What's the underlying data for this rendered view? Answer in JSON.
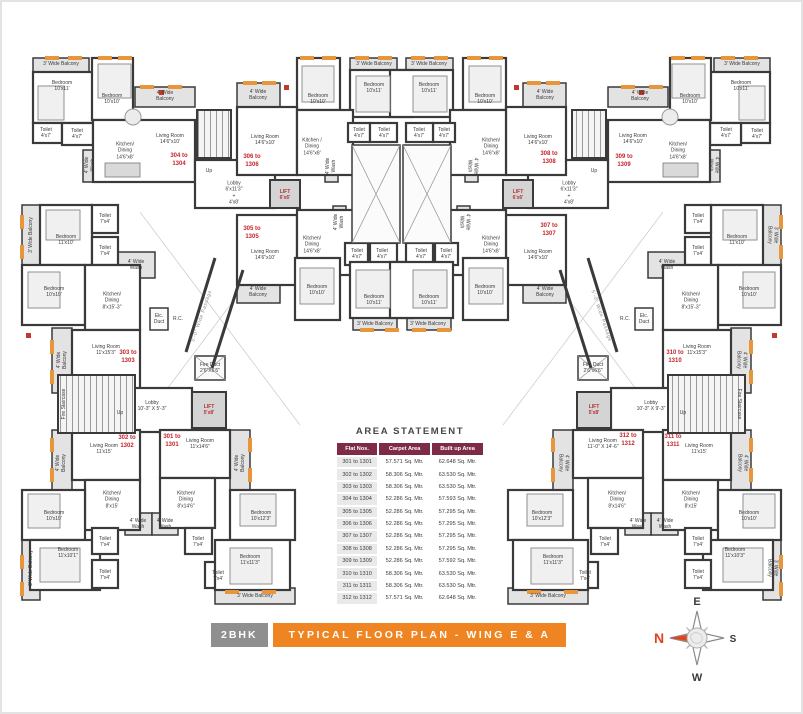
{
  "title_bar": {
    "badge": "2BHK",
    "title": "TYPICAL FLOOR PLAN - WING E & A"
  },
  "compass": {
    "north": "N",
    "east": "E",
    "south": "S",
    "west": "W"
  },
  "colors": {
    "accent_orange": "#ee8522",
    "wall": "#3a3a3a",
    "unit_red": "#c4242b",
    "table_maroon": "#7d2b47",
    "badge_gray": "#8f8f8f",
    "sill_orange": "#e8963c"
  },
  "area_statement": {
    "title": "AREA STATEMENT",
    "headers": [
      "Flat Nos.",
      "Carpet Area",
      "Built up Area"
    ],
    "rows": [
      [
        "301 to 1301",
        "57.571 Sq. Mtr.",
        "62.648 Sq. Mtr."
      ],
      [
        "302 to 1302",
        "58.306 Sq. Mtr.",
        "63.530 Sq. Mtr."
      ],
      [
        "303 to 1303",
        "58.306 Sq. Mtr.",
        "63.530 Sq. Mtr."
      ],
      [
        "304 to 1304",
        "52.286 Sq. Mtr.",
        "57.593 Sq. Mtr."
      ],
      [
        "305 to 1305",
        "52.286 Sq. Mtr.",
        "57.295 Sq. Mtr."
      ],
      [
        "306 to 1306",
        "52.286 Sq. Mtr.",
        "57.295 Sq. Mtr."
      ],
      [
        "307 to 1307",
        "52.286 Sq. Mtr.",
        "57.295 Sq. Mtr."
      ],
      [
        "308 to 1308",
        "52.286 Sq. Mtr.",
        "57.295 Sq. Mtr."
      ],
      [
        "309 to 1309",
        "52.286 Sq. Mtr.",
        "57.592 Sq. Mtr."
      ],
      [
        "310 to 1310",
        "58.306 Sq. Mtr.",
        "63.530 Sq. Mtr."
      ],
      [
        "311 to 1311",
        "58.306 Sq. Mtr.",
        "63.530 Sq. Mtr."
      ],
      [
        "312 to 1312",
        "57.571 Sq. Mtr.",
        "62.648 Sq. Mtr."
      ]
    ]
  },
  "plan": {
    "unit_labels": [
      {
        "t": "304 to\n1304",
        "x": 179,
        "y": 161
      },
      {
        "t": "306 to\n1306",
        "x": 252,
        "y": 162
      },
      {
        "t": "305 to\n1305",
        "x": 252,
        "y": 234
      },
      {
        "t": "308 to\n1308",
        "x": 549,
        "y": 159
      },
      {
        "t": "309 to\n1309",
        "x": 624,
        "y": 162
      },
      {
        "t": "307 to\n1307",
        "x": 549,
        "y": 231
      },
      {
        "t": "303 to\n1303",
        "x": 128,
        "y": 358
      },
      {
        "t": "302 to\n1302",
        "x": 127,
        "y": 443
      },
      {
        "t": "301 to\n1301",
        "x": 172,
        "y": 442
      },
      {
        "t": "310 to\n1310",
        "x": 675,
        "y": 358
      },
      {
        "t": "312 to\n1312",
        "x": 628,
        "y": 441
      },
      {
        "t": "311 to\n1311",
        "x": 673,
        "y": 442
      }
    ],
    "room_labels": [
      {
        "t": "3' Wide Balcony",
        "x": 61,
        "y": 64
      },
      {
        "t": "Bedroom\n10'x11'",
        "x": 62,
        "y": 86
      },
      {
        "t": "Bedroom\n10'x10'",
        "x": 112,
        "y": 99
      },
      {
        "t": "4' Wide\nBalcony",
        "x": 165,
        "y": 96
      },
      {
        "t": "Toilet\n4'x7'",
        "x": 46,
        "y": 133
      },
      {
        "t": "Toilet\n4'x7'",
        "x": 77,
        "y": 134
      },
      {
        "t": "Kitchen/\nDining\n14'6\"x8'",
        "x": 125,
        "y": 151
      },
      {
        "t": "Living Room\n14'6\"x10'",
        "x": 170,
        "y": 139
      },
      {
        "t": "4' Wide\nWash",
        "x": 90,
        "y": 165,
        "r": -90
      },
      {
        "t": "Up",
        "x": 209,
        "y": 171
      },
      {
        "t": "Lobby\n6'x11'3\"\n+\n4'x8'",
        "x": 234,
        "y": 193
      },
      {
        "t": "LIFT\n6'x6'",
        "x": 285,
        "y": 195,
        "c": "lift"
      },
      {
        "t": "4' Wide\nBalcony",
        "x": 258,
        "y": 95
      },
      {
        "t": "Bedroom\n10'x10'",
        "x": 318,
        "y": 99
      },
      {
        "t": "3' Wide Balcony",
        "x": 374,
        "y": 64
      },
      {
        "t": "Bedroom\n10'x11'",
        "x": 374,
        "y": 88
      },
      {
        "t": "Living Room\n14'6\"x10'",
        "x": 265,
        "y": 140
      },
      {
        "t": "Kitchen /\nDining\n14'6\"x8'",
        "x": 312,
        "y": 147
      },
      {
        "t": "Toilet\n4'x7'",
        "x": 359,
        "y": 133
      },
      {
        "t": "Toilet\n4'x7'",
        "x": 384,
        "y": 133
      },
      {
        "t": "4' Wide\nWash",
        "x": 331,
        "y": 166,
        "r": -90
      },
      {
        "t": "Living Room\n14'6\"x10'",
        "x": 265,
        "y": 255
      },
      {
        "t": "Kitchen/\nDining\n14'6\"x8'",
        "x": 312,
        "y": 245
      },
      {
        "t": "4' Wide\nWash",
        "x": 339,
        "y": 222,
        "r": -90
      },
      {
        "t": "Toilet\n4'x7'",
        "x": 357,
        "y": 254
      },
      {
        "t": "Toilet\n4'x7'",
        "x": 382,
        "y": 254
      },
      {
        "t": "Bedroom\n10'x10'",
        "x": 317,
        "y": 290
      },
      {
        "t": "Bedroom\n10'x11'",
        "x": 374,
        "y": 300
      },
      {
        "t": "3' Wide Balcony",
        "x": 375,
        "y": 324
      },
      {
        "t": "4' Wide\nBalcony",
        "x": 258,
        "y": 292
      },
      {
        "t": "4' Wide\nBalcony",
        "x": 545,
        "y": 95
      },
      {
        "t": "Bedroom\n10'x10'",
        "x": 485,
        "y": 99
      },
      {
        "t": "3' Wide Balcony",
        "x": 429,
        "y": 64
      },
      {
        "t": "Bedroom\n10'x11'",
        "x": 429,
        "y": 88
      },
      {
        "t": "Living Room\n14'6\"x10'",
        "x": 538,
        "y": 140
      },
      {
        "t": "Kitchen/\nDining\n14'6\"x8'",
        "x": 491,
        "y": 147
      },
      {
        "t": "Toilet\n4'x7'",
        "x": 419,
        "y": 133
      },
      {
        "t": "Toilet\n4'x7'",
        "x": 444,
        "y": 133
      },
      {
        "t": "4' Wide\nWash",
        "x": 472,
        "y": 166,
        "r": 90
      },
      {
        "t": "Living Room\n14'6\"x10'",
        "x": 538,
        "y": 255
      },
      {
        "t": "Kitchen/\nDining\n14'6\"x8'",
        "x": 491,
        "y": 245
      },
      {
        "t": "4' Wide\nWash",
        "x": 464,
        "y": 222,
        "r": 90
      },
      {
        "t": "Toilet\n4'x7'",
        "x": 421,
        "y": 254
      },
      {
        "t": "Toilet\n4'x7'",
        "x": 446,
        "y": 254
      },
      {
        "t": "Bedroom\n10'x10'",
        "x": 485,
        "y": 290
      },
      {
        "t": "Bedroom\n10'x11'",
        "x": 429,
        "y": 300
      },
      {
        "t": "3' Wide Balcony",
        "x": 428,
        "y": 324
      },
      {
        "t": "4' Wide\nBalcony",
        "x": 545,
        "y": 292
      },
      {
        "t": "4' Wide\nBalcony",
        "x": 640,
        "y": 96
      },
      {
        "t": "Bedroom\n10'x10'",
        "x": 690,
        "y": 99
      },
      {
        "t": "3' Wide Balcony",
        "x": 742,
        "y": 64
      },
      {
        "t": "Bedroom\n10'x11'",
        "x": 741,
        "y": 86
      },
      {
        "t": "Toilet\n4'x7'",
        "x": 726,
        "y": 133
      },
      {
        "t": "Toilet\n4'x7'",
        "x": 757,
        "y": 134
      },
      {
        "t": "Kitchen/\nDining\n14'6\"x8'",
        "x": 678,
        "y": 151
      },
      {
        "t": "Living Room\n14'6\"x10'",
        "x": 633,
        "y": 139
      },
      {
        "t": "4' Wide\nWash",
        "x": 713,
        "y": 165,
        "r": 90
      },
      {
        "t": "Up",
        "x": 594,
        "y": 171
      },
      {
        "t": "Lobby\n6'x11'3\"\n+\n4'x8'",
        "x": 569,
        "y": 193
      },
      {
        "t": "LIFT\n6'x6'",
        "x": 518,
        "y": 195,
        "c": "lift"
      },
      {
        "t": "3' Wide Balcony",
        "x": 31,
        "y": 235,
        "r": -90
      },
      {
        "t": "Bedroom\n11'x10'",
        "x": 66,
        "y": 240
      },
      {
        "t": "Toilet\n7'x4'",
        "x": 105,
        "y": 219
      },
      {
        "t": "Toilet\n7'x4'",
        "x": 105,
        "y": 251
      },
      {
        "t": "Bedroom\n10'x10'",
        "x": 54,
        "y": 292
      },
      {
        "t": "4' Wide\nWash",
        "x": 136,
        "y": 265
      },
      {
        "t": "Kitchen/\nDining\n8'x15'-3\"",
        "x": 112,
        "y": 301
      },
      {
        "t": "Elc.\nDuct",
        "x": 159,
        "y": 319
      },
      {
        "t": "R.C.",
        "x": 178,
        "y": 319
      },
      {
        "t": "4' Wide\nBalcony",
        "x": 62,
        "y": 360,
        "r": -90
      },
      {
        "t": "Living Room\n11'x15'3\"",
        "x": 106,
        "y": 350
      },
      {
        "t": "5'-0\" Wide Passage",
        "x": 202,
        "y": 316,
        "r": -71,
        "c": "pass"
      },
      {
        "t": "Fire Staircase",
        "x": 64,
        "y": 404,
        "r": -90
      },
      {
        "t": "Up",
        "x": 120,
        "y": 413
      },
      {
        "t": "Lobby\n10'-3\" X 5'-3\"",
        "x": 152,
        "y": 406
      },
      {
        "t": "LIFT\n5'x8'",
        "x": 209,
        "y": 410,
        "c": "lift"
      },
      {
        "t": "Fire Duct\n2'6\"X6'6\"",
        "x": 210,
        "y": 368
      },
      {
        "t": "Living Room\n11'x15'",
        "x": 104,
        "y": 449
      },
      {
        "t": "4' Wide\nBalcony",
        "x": 61,
        "y": 463,
        "r": -90
      },
      {
        "t": "Kitchen/\nDining\n8'x15'",
        "x": 112,
        "y": 500
      },
      {
        "t": "4' Wide\nWash",
        "x": 138,
        "y": 524
      },
      {
        "t": "Bedroom\n10'x10'",
        "x": 54,
        "y": 516
      },
      {
        "t": "Bedroom\n11'x10'1\"",
        "x": 68,
        "y": 553
      },
      {
        "t": "3' Wide Balcony",
        "x": 31,
        "y": 568,
        "r": -90
      },
      {
        "t": "Toilet\n7'x4'",
        "x": 105,
        "y": 542
      },
      {
        "t": "Toilet\n7'x4'",
        "x": 105,
        "y": 575
      },
      {
        "t": "Living Room\n11'x14'6\"",
        "x": 200,
        "y": 444
      },
      {
        "t": "4' Wide\nBalcony",
        "x": 240,
        "y": 463,
        "r": -90
      },
      {
        "t": "Kitchen/\nDining\n8'x14'6\"",
        "x": 186,
        "y": 500
      },
      {
        "t": "4' Wide\nWash",
        "x": 165,
        "y": 524
      },
      {
        "t": "Toilet\n7'x4'",
        "x": 198,
        "y": 542
      },
      {
        "t": "Toilet\n7'x4'",
        "x": 218,
        "y": 576
      },
      {
        "t": "Bedroom\n10'x12'3\"",
        "x": 261,
        "y": 516
      },
      {
        "t": "Bedroom\n11'x11'3\"",
        "x": 250,
        "y": 560
      },
      {
        "t": "3' Wide Balcony",
        "x": 255,
        "y": 596
      },
      {
        "t": "3' Wide Balcony",
        "x": 772,
        "y": 235,
        "r": 90
      },
      {
        "t": "Bedroom\n11'x10'",
        "x": 737,
        "y": 240
      },
      {
        "t": "Toilet\n7'x4'",
        "x": 698,
        "y": 219
      },
      {
        "t": "Toilet\n7'x4'",
        "x": 698,
        "y": 251
      },
      {
        "t": "Bedroom\n10'x10'",
        "x": 749,
        "y": 292
      },
      {
        "t": "4' Wide\nWash",
        "x": 667,
        "y": 265
      },
      {
        "t": "Kitchen/\nDining\n8'x15'-3\"",
        "x": 691,
        "y": 301
      },
      {
        "t": "Elc.\nDuct",
        "x": 644,
        "y": 319
      },
      {
        "t": "R.C.",
        "x": 625,
        "y": 319
      },
      {
        "t": "4' Wide\nBalcony",
        "x": 741,
        "y": 360,
        "r": 90
      },
      {
        "t": "Living Room\n11'x15'3\"",
        "x": 697,
        "y": 350
      },
      {
        "t": "5'-0\" Wide Passage",
        "x": 601,
        "y": 316,
        "r": 71,
        "c": "pass"
      },
      {
        "t": "Fire Staircase",
        "x": 739,
        "y": 404,
        "r": 90
      },
      {
        "t": "Up",
        "x": 683,
        "y": 413
      },
      {
        "t": "Lobby\n10'-3\" X 9'-3\"",
        "x": 651,
        "y": 406
      },
      {
        "t": "LIFT\n5'x8'",
        "x": 594,
        "y": 410,
        "c": "lift"
      },
      {
        "t": "Fire Duct\n2'6\"x6'6\"",
        "x": 593,
        "y": 368
      },
      {
        "t": "Living Room\n11'-0\" X 14'-6\"",
        "x": 603,
        "y": 444
      },
      {
        "t": "4' Wide\nBalcony",
        "x": 563,
        "y": 463,
        "r": 90
      },
      {
        "t": "Kitchen/\nDining\n8'x14'6\"",
        "x": 617,
        "y": 500
      },
      {
        "t": "4' Wide\nWash",
        "x": 638,
        "y": 524
      },
      {
        "t": "Toilet\n7'x4'",
        "x": 605,
        "y": 542
      },
      {
        "t": "Toilet\n7'x4'",
        "x": 585,
        "y": 576
      },
      {
        "t": "Bedroom\n10'x12'3\"",
        "x": 542,
        "y": 516
      },
      {
        "t": "Bedroom\n11'x11'3\"",
        "x": 553,
        "y": 560
      },
      {
        "t": "3' Wide Balcony",
        "x": 548,
        "y": 596
      },
      {
        "t": "Living Room\n11'x15'",
        "x": 699,
        "y": 449
      },
      {
        "t": "4' Wide\nBalcony",
        "x": 742,
        "y": 463,
        "r": 90
      },
      {
        "t": "Kitchen/\nDining\n8'x15'",
        "x": 691,
        "y": 500
      },
      {
        "t": "4' Wide\nWash",
        "x": 665,
        "y": 524
      },
      {
        "t": "Bedroom\n10'x10'",
        "x": 749,
        "y": 516
      },
      {
        "t": "Bedroom\n11'x10'3\"",
        "x": 735,
        "y": 553
      },
      {
        "t": "3' Wide Balcony",
        "x": 772,
        "y": 568,
        "r": 90
      },
      {
        "t": "Toilet\n7'x4'",
        "x": 698,
        "y": 542
      },
      {
        "t": "Toilet\n7'x4'",
        "x": 698,
        "y": 575
      }
    ]
  }
}
